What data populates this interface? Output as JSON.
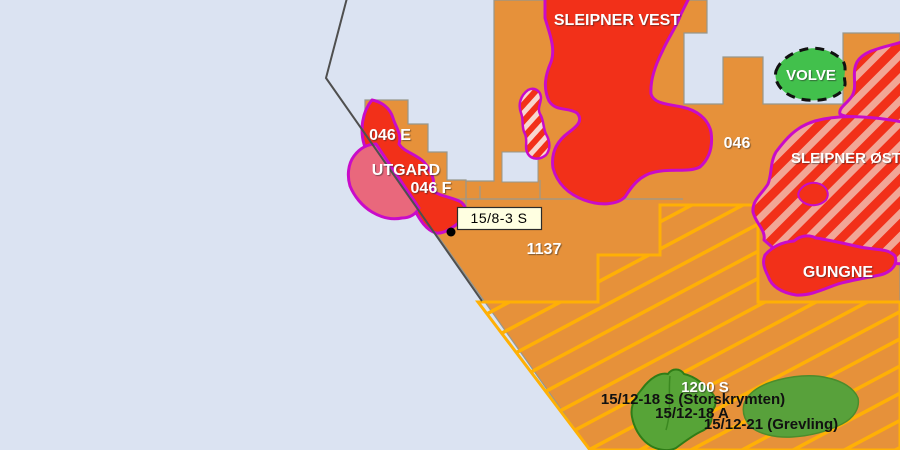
{
  "map": {
    "kind": "offshore-petroleum-licence-map",
    "colors": {
      "sea": "#dbe3f2",
      "licence_block": "#e6913a",
      "block_outline": "#97978c",
      "hatch_area_line": "#ffb005",
      "field_red": "#f23019",
      "field_border": "#c90bc9",
      "field_stripe_pink": "#f2a696",
      "candy_stripe_light": "#f8d7cf",
      "utgard_west_pink": "#e9687c",
      "volve_green": "#42c04c",
      "volve_outline": "#111111",
      "discovery_green": "#57a437",
      "discovery_green_dark": "#2f7c17",
      "grevling_green": "#58a13b",
      "grevling_outline": "#4c8c2c",
      "boundary_line": "#4f4f4f",
      "thin_block_line": "#9a9a8f",
      "marker_black": "#000000"
    },
    "labels": [
      {
        "id": "sleipner-vest",
        "text": "SLEIPNER VEST",
        "color": "#ffffff",
        "x": 617,
        "y": 25,
        "size": 16
      },
      {
        "id": "volve",
        "text": "VOLVE",
        "color": "#ffffff",
        "x": 811,
        "y": 80,
        "size": 15
      },
      {
        "id": "block-046",
        "text": "046",
        "color": "#ffffff",
        "x": 737,
        "y": 148,
        "size": 16
      },
      {
        "id": "sleipner-ost",
        "text": "SLEIPNER ØST",
        "color": "#ffffff",
        "x": 846,
        "y": 163,
        "size": 15
      },
      {
        "id": "gungne",
        "text": "GUNGNE",
        "color": "#ffffff",
        "x": 838,
        "y": 277,
        "size": 16
      },
      {
        "id": "block-046e",
        "text": "046 E",
        "color": "#ffffff",
        "x": 390,
        "y": 140,
        "size": 16
      },
      {
        "id": "utgard",
        "text": "UTGARD",
        "color": "#ffffff",
        "x": 406,
        "y": 175,
        "size": 16
      },
      {
        "id": "block-046f",
        "text": "046 F",
        "color": "#ffffff",
        "x": 431,
        "y": 193,
        "size": 16
      },
      {
        "id": "block-1137",
        "text": "1137",
        "color": "#ffffff",
        "x": 544,
        "y": 254,
        "size": 16
      },
      {
        "id": "block-1200s",
        "text": "1200 S",
        "color": "#ffffff",
        "x": 705,
        "y": 392,
        "size": 15
      },
      {
        "id": "disc-storskrymten",
        "text": "15/12-18 S (Storskrymten)",
        "color": "#111111",
        "x": 693,
        "y": 404,
        "size": 15
      },
      {
        "id": "disc-18a",
        "text": "15/12-18 A",
        "color": "#111111",
        "x": 692,
        "y": 418,
        "size": 15
      },
      {
        "id": "disc-grevling",
        "text": "15/12-21 (Grevling)",
        "color": "#111111",
        "x": 771,
        "y": 429,
        "size": 15
      }
    ],
    "tooltip": {
      "text": "15/8-3 S",
      "bg": "#ffffe1",
      "border": "#2b2b2b"
    }
  }
}
